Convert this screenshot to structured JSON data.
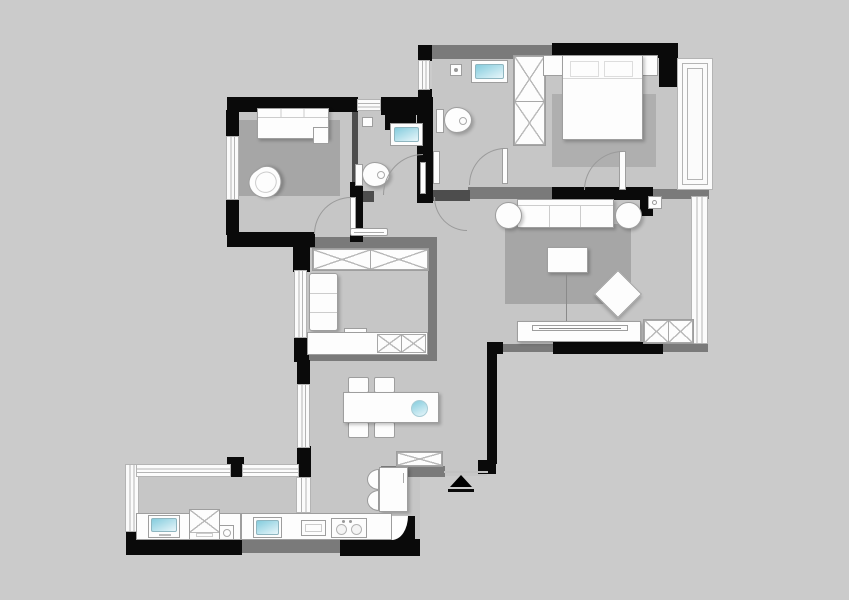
{
  "document": {
    "kind": "apartment-floor-plan",
    "visible_text": []
  },
  "colors": {
    "bg": "#cbcbcb",
    "floor": "#c6c6c6",
    "wall-black": "#0a0a0a",
    "wall-gray": "#7a7a7a",
    "wall-dark": "#4d4d4d",
    "furn": "#fdfdfd",
    "furn-line": "#9e9e9e",
    "rug": "#a6a6a6",
    "rug-master": "#afafaf",
    "sink-blue-1": "#84ccdd",
    "sink-blue-2": "#e8f6fa",
    "window-line": "#b4b4b4",
    "arc-line": "#9a9a9a"
  },
  "rooms": [
    {
      "name": "bedroom-2",
      "furniture": [
        "daybed",
        "side-cushion",
        "rug",
        "armchair",
        "door-leaf"
      ]
    },
    {
      "name": "bathroom-1",
      "furniture": [
        "wall-box",
        "wash-basin",
        "toilet",
        "door-leaf"
      ]
    },
    {
      "name": "bathroom-2",
      "furniture": [
        "shower-head",
        "wash-basin",
        "toilet",
        "door-leaf",
        "door-post"
      ]
    },
    {
      "name": "master-bedroom",
      "furniture": [
        "wardrobe-x",
        "nightstand-left",
        "double-bed",
        "pillow",
        "pillow",
        "nightstand-right",
        "rug",
        "door-leaf",
        "bay-window"
      ]
    },
    {
      "name": "living-room",
      "furniture": [
        "sofa",
        "side-table-left",
        "side-table-right",
        "wall-unit",
        "rug",
        "coffee-table",
        "ottoman-diamond",
        "tv-bench",
        "tv",
        "cabinet-x",
        "window"
      ]
    },
    {
      "name": "study",
      "furniture": [
        "wardrobe-x",
        "seat",
        "counter",
        "counter-box",
        "cabinet-x"
      ]
    },
    {
      "name": "hallway",
      "furniture": [
        "ceiling-lamp"
      ]
    },
    {
      "name": "dining",
      "furniture": [
        "chair",
        "chair",
        "chair",
        "chair",
        "dining-table",
        "lazy-susan"
      ]
    },
    {
      "name": "foyer",
      "furniture": [
        "shoe-cabinet-x",
        "refrigerator",
        "fridge-door-arcs",
        "entry-arrow"
      ]
    },
    {
      "name": "kitchen",
      "furniture": [
        "counter",
        "sink",
        "drainer-board",
        "cooktop-2-burner",
        "corner-unit"
      ]
    },
    {
      "name": "balcony-laundry",
      "furniture": [
        "counter",
        "laundry-basin",
        "washing-machine",
        "water-heater"
      ]
    }
  ]
}
